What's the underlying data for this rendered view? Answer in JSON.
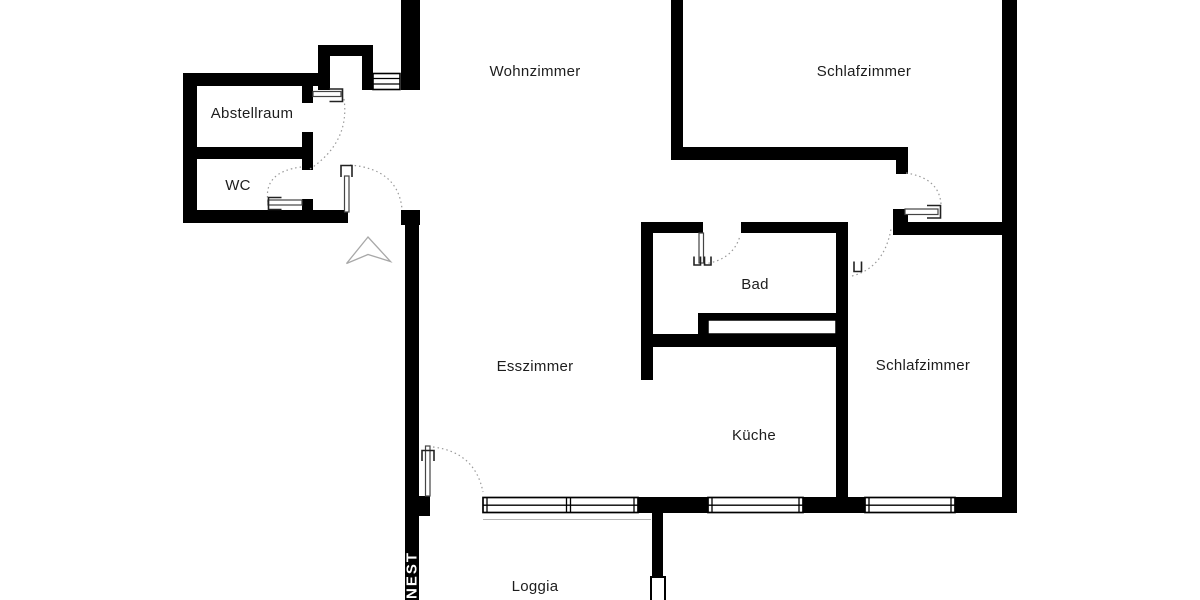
{
  "plan": {
    "title": "Apartment floor plan",
    "watermark": "NEST",
    "colors": {
      "wall": "#000000",
      "background": "#ffffff",
      "door_arc": "#999999",
      "label": "#1d1d1d",
      "watermark_text": "#ffffff",
      "entrance_arrow": "#a8a8a8"
    },
    "rooms": [
      {
        "id": "wohnzimmer",
        "label": "Wohnzimmer"
      },
      {
        "id": "schlafzimmer-1",
        "label": "Schlafzimmer"
      },
      {
        "id": "abstellraum",
        "label": "Abstellraum"
      },
      {
        "id": "wc",
        "label": "WC"
      },
      {
        "id": "bad",
        "label": "Bad"
      },
      {
        "id": "esszimmer",
        "label": "Esszimmer"
      },
      {
        "id": "schlafzimmer-2",
        "label": "Schlafzimmer"
      },
      {
        "id": "kueche",
        "label": "Küche"
      },
      {
        "id": "loggia",
        "label": "Loggia"
      }
    ]
  }
}
